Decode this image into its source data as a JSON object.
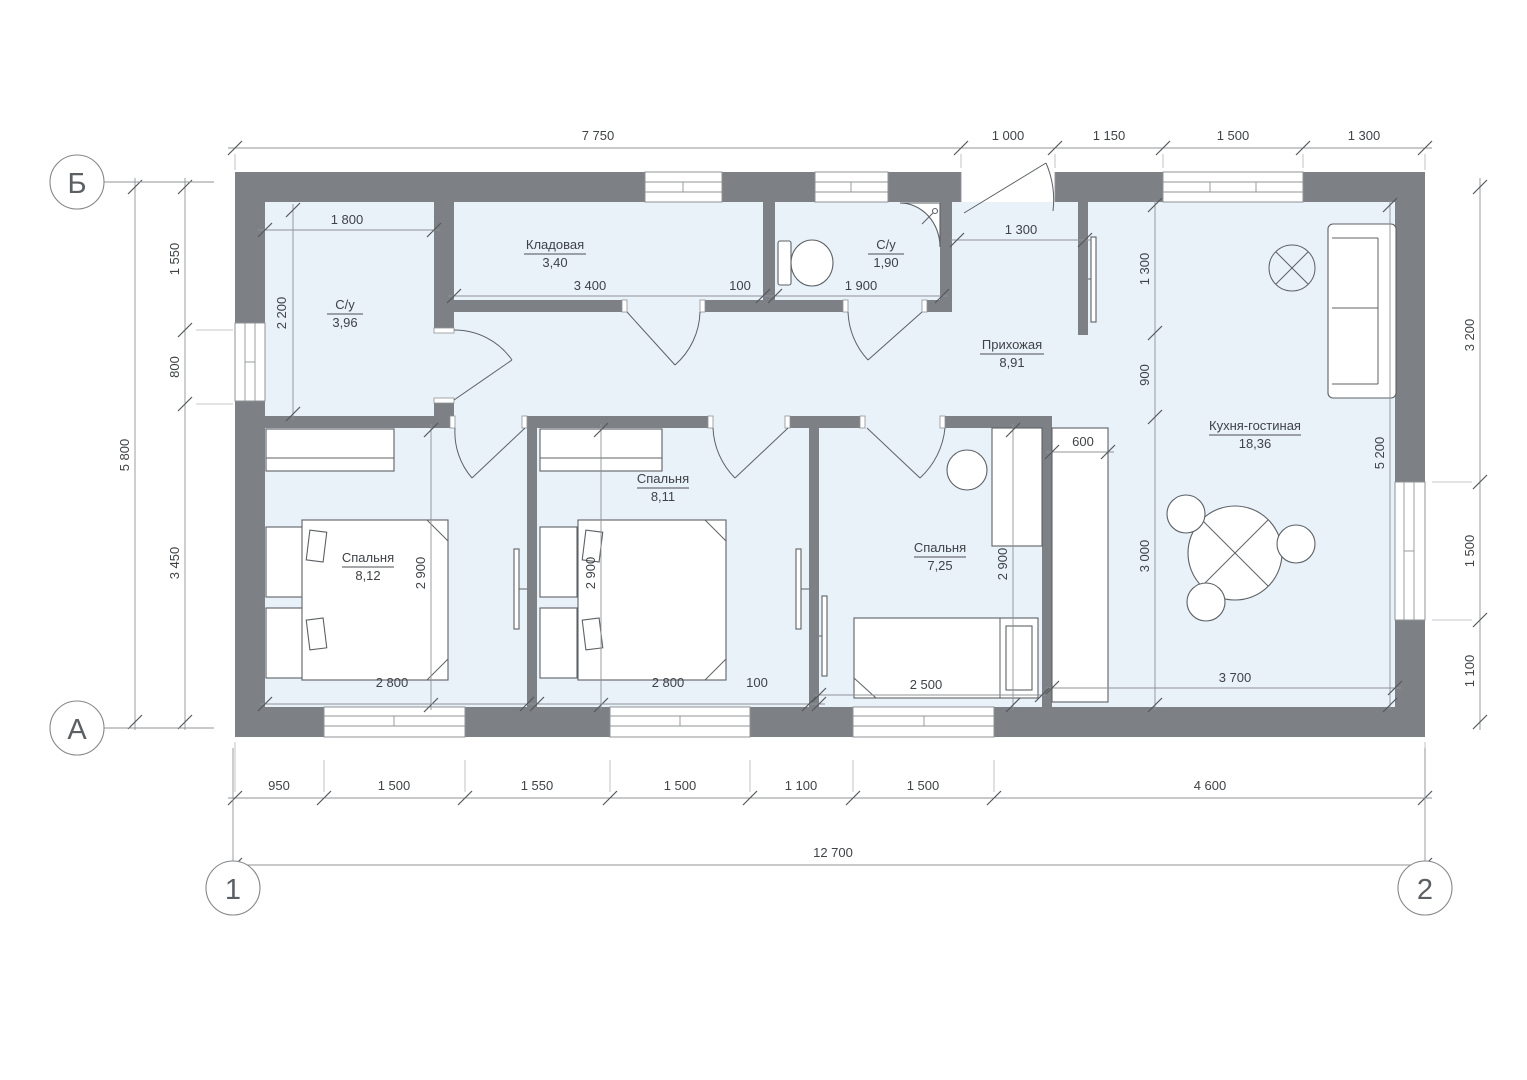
{
  "markers": {
    "axis_b": "Б",
    "axis_a": "А",
    "axis_1": "1",
    "axis_2": "2"
  },
  "rooms": {
    "bath1": {
      "name": "С/у",
      "area": "3,96"
    },
    "storage": {
      "name": "Кладовая",
      "area": "3,40"
    },
    "bath2": {
      "name": "С/у",
      "area": "1,90"
    },
    "hall": {
      "name": "Прихожая",
      "area": "8,91"
    },
    "kitchen": {
      "name": "Кухня-гостиная",
      "area": "18,36"
    },
    "bedroom1": {
      "name": "Спальня",
      "area": "8,12"
    },
    "bedroom2": {
      "name": "Спальня",
      "area": "8,11"
    },
    "bedroom3": {
      "name": "Спальня",
      "area": "7,25"
    }
  },
  "dims": {
    "top": [
      "7 750",
      "1 000",
      "1 150",
      "1 500",
      "1 300"
    ],
    "bottom": [
      "950",
      "1 500",
      "1 550",
      "1 500",
      "1 100",
      "1 500",
      "4 600"
    ],
    "bottom_total": "12 700",
    "left": [
      "1 550",
      "800",
      "3 450"
    ],
    "left_total": "5 800",
    "right": [
      "3 200",
      "1 500",
      "1 100"
    ],
    "interior": {
      "w1800": "1 800",
      "h2200": "2 200",
      "w3400": "3 400",
      "w100a": "100",
      "w1900": "1 900",
      "hall1300": "1 300",
      "v1300": "1 300",
      "v900": "900",
      "v3000": "3 000",
      "v5200": "5 200",
      "w600": "600",
      "w3700": "3 700",
      "b1w": "2 800",
      "b1h": "2 900",
      "b2w": "2 800",
      "b2h": "2 900",
      "wall100": "100",
      "b3w": "2 500",
      "b3h": "2 900"
    }
  },
  "colors": {
    "wall": "#7d8084",
    "floor": "#e9f1f9",
    "accent_line": "#8f9396"
  }
}
